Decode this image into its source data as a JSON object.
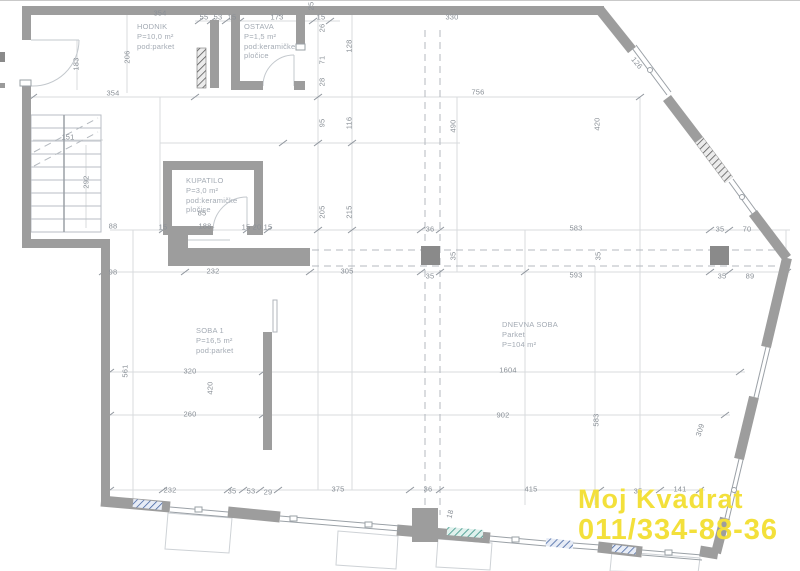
{
  "watermark": {
    "line1": "Moj Kvadrat",
    "line2": "011/334-88-36",
    "color": "#f3e03b"
  },
  "rooms": [
    {
      "x": 137,
      "y": 22,
      "lines": [
        "HODNIK",
        "P=10,0 m²",
        "pod:parket"
      ]
    },
    {
      "x": 244,
      "y": 22,
      "lines": [
        "OSTAVA",
        "P=1,5 m²",
        "pod:keramičke",
        "pločice"
      ]
    },
    {
      "x": 186,
      "y": 176,
      "lines": [
        "KUPATILO",
        "P=3,0 m²",
        "pod:keramičke",
        "pločice"
      ]
    },
    {
      "x": 196,
      "y": 326,
      "lines": [
        "SOBA 1",
        "P=16,5 m²",
        "pod:parket"
      ]
    },
    {
      "x": 502,
      "y": 320,
      "lines": [
        "DNEVNA SOBA",
        "Parket",
        "P=104 m²"
      ]
    }
  ],
  "dimensions": [
    {
      "t": "354",
      "x": 160,
      "y": 13
    },
    {
      "t": "55",
      "x": 204,
      "y": 17
    },
    {
      "t": "53",
      "x": 218,
      "y": 17
    },
    {
      "t": "15",
      "x": 232,
      "y": 17
    },
    {
      "t": "173",
      "x": 277,
      "y": 17
    },
    {
      "t": "15",
      "x": 321,
      "y": 17
    },
    {
      "t": "25",
      "x": 311,
      "y": 6,
      "r": -90
    },
    {
      "t": "330",
      "x": 452,
      "y": 17
    },
    {
      "t": "128",
      "x": 349,
      "y": 46,
      "r": -90
    },
    {
      "t": "26",
      "x": 322,
      "y": 28,
      "r": -90
    },
    {
      "t": "71",
      "x": 322,
      "y": 60,
      "r": -90
    },
    {
      "t": "28",
      "x": 322,
      "y": 82,
      "r": -90
    },
    {
      "t": "756",
      "x": 478,
      "y": 92
    },
    {
      "t": "183",
      "x": 76,
      "y": 64,
      "r": -90
    },
    {
      "t": "206",
      "x": 127,
      "y": 57,
      "r": -90
    },
    {
      "t": "354",
      "x": 113,
      "y": 93
    },
    {
      "t": "151",
      "x": 68,
      "y": 137
    },
    {
      "t": "292",
      "x": 86,
      "y": 182,
      "r": -90
    },
    {
      "t": "95",
      "x": 322,
      "y": 123,
      "r": -90
    },
    {
      "t": "116",
      "x": 349,
      "y": 123,
      "r": -90
    },
    {
      "t": "205",
      "x": 322,
      "y": 212,
      "r": -90
    },
    {
      "t": "215",
      "x": 349,
      "y": 212,
      "r": -90
    },
    {
      "t": "490",
      "x": 453,
      "y": 126,
      "r": -90
    },
    {
      "t": "420",
      "x": 597,
      "y": 124,
      "r": -90
    },
    {
      "t": "126",
      "x": 637,
      "y": 63,
      "r": 51
    },
    {
      "t": "88",
      "x": 113,
      "y": 226
    },
    {
      "t": "15",
      "x": 163,
      "y": 227
    },
    {
      "t": "188",
      "x": 205,
      "y": 226
    },
    {
      "t": "15",
      "x": 246,
      "y": 227
    },
    {
      "t": "20",
      "x": 257,
      "y": 227
    },
    {
      "t": "15",
      "x": 268,
      "y": 227
    },
    {
      "t": "85",
      "x": 202,
      "y": 213
    },
    {
      "t": "98",
      "x": 113,
      "y": 272
    },
    {
      "t": "232",
      "x": 213,
      "y": 271
    },
    {
      "t": "305",
      "x": 347,
      "y": 271
    },
    {
      "t": "36",
      "x": 430,
      "y": 229
    },
    {
      "t": "583",
      "x": 576,
      "y": 228
    },
    {
      "t": "35",
      "x": 430,
      "y": 276
    },
    {
      "t": "593",
      "x": 576,
      "y": 275
    },
    {
      "t": "35",
      "x": 453,
      "y": 256,
      "r": -90
    },
    {
      "t": "35",
      "x": 598,
      "y": 256,
      "r": -90
    },
    {
      "t": "35",
      "x": 720,
      "y": 229
    },
    {
      "t": "70",
      "x": 747,
      "y": 229
    },
    {
      "t": "35",
      "x": 722,
      "y": 276
    },
    {
      "t": "89",
      "x": 750,
      "y": 276
    },
    {
      "t": "561",
      "x": 125,
      "y": 371,
      "r": -90
    },
    {
      "t": "320",
      "x": 190,
      "y": 371
    },
    {
      "t": "420",
      "x": 210,
      "y": 388,
      "r": -90
    },
    {
      "t": "260",
      "x": 190,
      "y": 414
    },
    {
      "t": "1604",
      "x": 508,
      "y": 370
    },
    {
      "t": "902",
      "x": 503,
      "y": 415
    },
    {
      "t": "583",
      "x": 596,
      "y": 420,
      "r": -90
    },
    {
      "t": "232",
      "x": 170,
      "y": 490
    },
    {
      "t": "35",
      "x": 232,
      "y": 491
    },
    {
      "t": "53",
      "x": 251,
      "y": 491
    },
    {
      "t": "29",
      "x": 268,
      "y": 492
    },
    {
      "t": "375",
      "x": 338,
      "y": 489
    },
    {
      "t": "36",
      "x": 428,
      "y": 489
    },
    {
      "t": "415",
      "x": 531,
      "y": 489
    },
    {
      "t": "18",
      "x": 450,
      "y": 514,
      "r": -75
    },
    {
      "t": "35",
      "x": 638,
      "y": 491
    },
    {
      "t": "141",
      "x": 680,
      "y": 489
    },
    {
      "t": "309",
      "x": 700,
      "y": 430,
      "r": -72
    }
  ]
}
